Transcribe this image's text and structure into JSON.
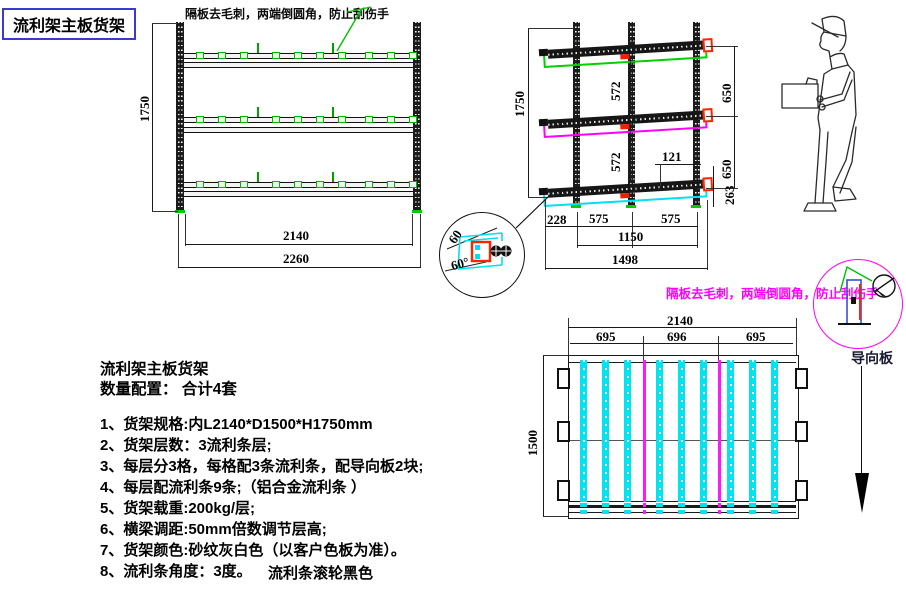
{
  "title": "流利架主板货架",
  "annotations": {
    "deburr_note_top": "隔板去毛刺，两端倒圆角，防止刮伤手",
    "deburr_note_right": "隔板去毛刺，两端倒圆角，防止刮伤手",
    "guide_plate_label": "导向板",
    "roller_color_note": "流利条滚轮黑色"
  },
  "detail_view": {
    "angle_top": "60",
    "angle_bottom": "60°"
  },
  "front_view": {
    "dims": {
      "height": "1750",
      "inner_width": "2140",
      "outer_width": "2260"
    }
  },
  "side_view": {
    "dims": {
      "height": "1750",
      "gap_upper": "572",
      "gap_lower": "572",
      "pitch_upper": "650",
      "pitch_lower": "650",
      "offset_top": "121",
      "bottom_height": "263",
      "front_overhang": "228",
      "bay_front": "575",
      "bay_rear": "575",
      "bay_total": "1150",
      "depth_total": "1498"
    }
  },
  "top_view": {
    "dims": {
      "width": "2140",
      "bay_left": "695",
      "bay_center": "696",
      "bay_right": "695",
      "depth": "1500"
    }
  },
  "specs": {
    "heading": "流利架主板货架",
    "quantity_line": "数量配置：  合计4套",
    "items": [
      "1、货架规格:内L2140*D1500*H1750mm",
      "2、货架层数：3流利条层;",
      "3、每层分3格，每格配3条流利条，配导向板2块;",
      "4、每层配流利条9条;（铝合金流利条 ）",
      "5、货架载重:200kg/层;",
      "6、横梁调距:50mm倍数调节层高;",
      "7、货架颜色:砂纹灰白色（以客户色板为准）。",
      "8、流利条角度：3度。"
    ]
  },
  "colors": {
    "rail_outline_top": "#00d000",
    "rail_outline_middle": "#ff00ff",
    "rail_outline_bottom": "#00e0f0",
    "strip_cyan": "#00e4f2",
    "guide_strip_magenta": "#ff18ff",
    "highlight_red": "#ff2400",
    "title_border_blue": "#3a3ad0",
    "note_magenta": "#ff00ff"
  }
}
